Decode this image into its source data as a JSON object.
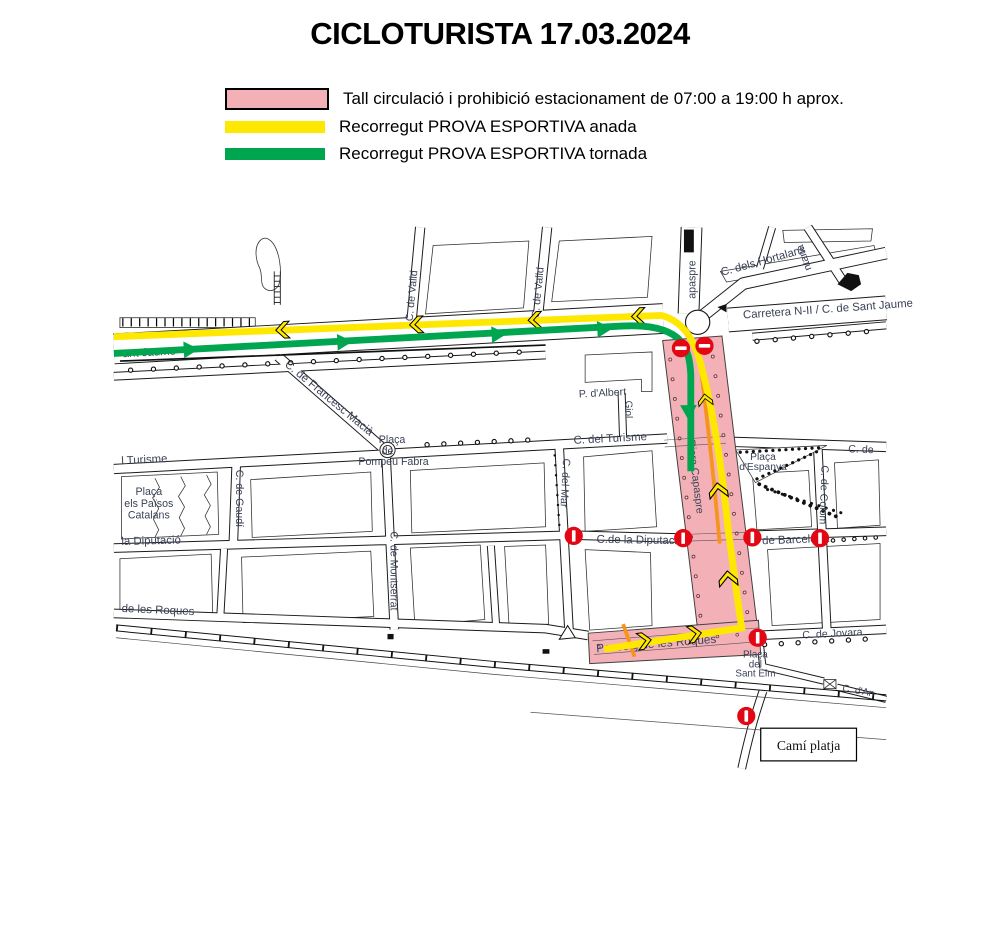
{
  "title": "CICLOTURISTA 17.03.2024",
  "legend": [
    {
      "label": "Tall circulació i prohibició estacionament de 07:00 a 19:00 h aprox.",
      "swatch": "closure-zone"
    },
    {
      "label": "Recorregut PROVA ESPORTIVA anada",
      "swatch": "route-anada"
    },
    {
      "label": "Recorregut PROVA ESPORTIVA tornada",
      "swatch": "route-tornada"
    }
  ],
  "colors": {
    "closure_zone": "#f3b1b7",
    "route_anada": "#ffe800",
    "route_tornada": "#00a550",
    "route_alt": "#f7941d",
    "no_entry": "#e30613",
    "street_label": "#3a4257"
  },
  "map": {
    "streets": {
      "sant_jaume": "ant Jaume",
      "carretera_n2": "Carretera N-II / C. de Sant Jaume",
      "hortalans": "C. dels Hortalans",
      "capaspre_nord": "apaspre",
      "muntana": "ntana",
      "valld_oest": "C. de Valld",
      "valld_est": "C. de Valld",
      "francesc_macia": "C. de Francesc Macià",
      "turisme_oest": "l Turisme",
      "turisme": "C. del Turisme",
      "c_de_est": "C. de",
      "gaudi": "C. de Gaudí",
      "montserrat": "C. de Montserrat",
      "mar": "C. del Mar",
      "colom": "C. de Colom",
      "giol": "Giol",
      "albert": "P. d'Albert",
      "diputacio_oest": "la Diputació",
      "diputacio": "C.de la Diputació",
      "barcelona": "de Barcelona",
      "roques_oest": "de les Roques",
      "passeig_roques": "Passeig de les Roques",
      "jovara": "C. de Jovara",
      "dan": "C. d'An",
      "riera_capaspre": "Riera Capaspre"
    },
    "places": {
      "pompeu_fabra": [
        "Plaça",
        "de",
        "Pompeu Fabra"
      ],
      "paisos_catalans": [
        "Plaça",
        "els Països",
        "Catalans"
      ],
      "espanya": [
        "Plaça",
        "d'Espanya"
      ],
      "sant_elm": [
        "Plaça",
        "del",
        "Sant Elm"
      ],
      "cami_platja": "Camí platja"
    }
  }
}
